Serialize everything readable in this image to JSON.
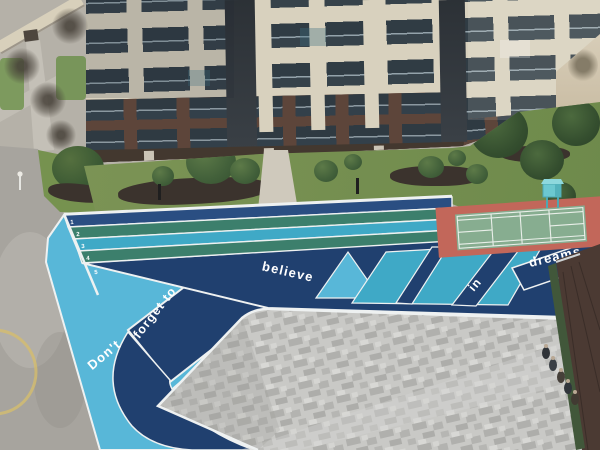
{
  "scene": {
    "description": "Aerial photo of a residential courtyard: apartment building, landscaped beds, colorful running track with painted slogan, badminton court, gray pixel-paved plaza, road and small roof",
    "track": {
      "slogan_words": [
        "Don't",
        "forget to",
        "believe",
        "in",
        "dreams"
      ],
      "slogan_full": "Don't forget to believe in dreams",
      "lane_numbers": [
        "1",
        "2",
        "3",
        "4",
        "5"
      ],
      "colors": {
        "sky_blue": "#58b7d8",
        "navy": "#20406f",
        "lane_navy": "#2a4e82",
        "teal_green": "#3c7f6c",
        "cyan": "#3fa9c6",
        "curb_white": "#eef1f1"
      }
    },
    "badminton_court": {
      "surface_green": "#87ad90",
      "surround_red": "#c2675a",
      "line_white": "#e9efe9",
      "equipment_tower_teal": "#6cc8d0"
    },
    "plaza": {
      "paving_light": "#c9c9c6",
      "paving_dark": "#aeaeab"
    },
    "building": {
      "facade_cream": "#d8d1be",
      "facade_brown": "#5d453a",
      "glass_dark": "#303c44"
    },
    "landscape": {
      "grass_green": "#7c9355",
      "bush_green": "#44613a",
      "mulch_dark": "#3b332d"
    },
    "road_gray": "#a7a49e",
    "roof_brown": "#4b3a33",
    "people_count": 5
  }
}
